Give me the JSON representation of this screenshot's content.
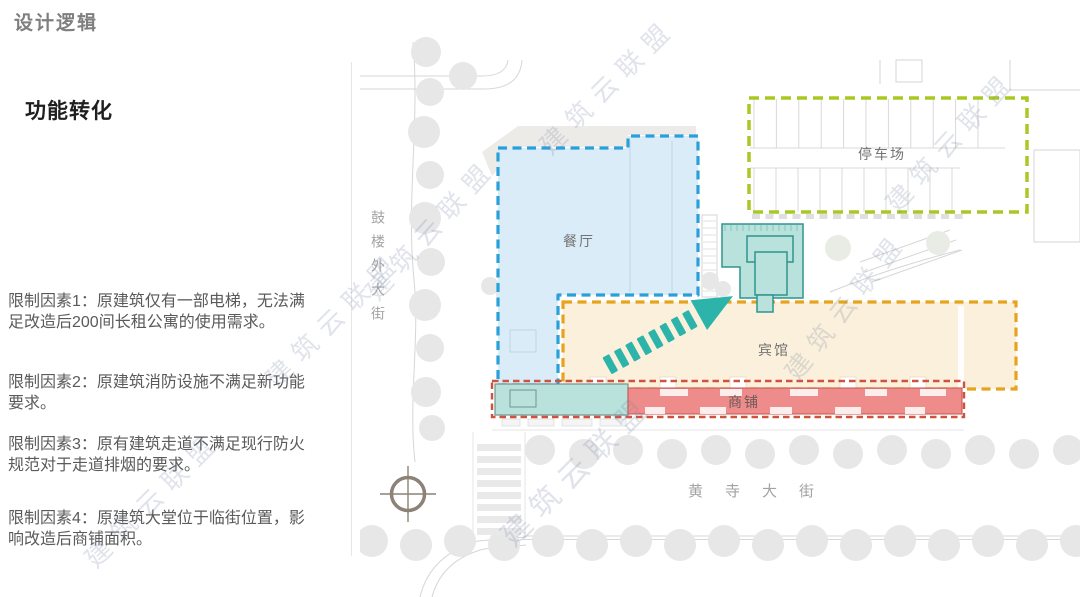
{
  "page": {
    "title": "设计逻辑",
    "section_title": "功能转化"
  },
  "constraints": [
    "限制因素1：原建筑仅有一部电梯，无法满足改造后200间长租公寓的使用需求。",
    "限制因素2：原建筑消防设施不满足新功能要求。",
    "限制因素3：原有建筑走道不满足现行防火规范对于走道排烟的要求。",
    "限制因素4：原建筑大堂位于临街位置，影响改造后商铺面积。"
  ],
  "plan": {
    "zones": {
      "restaurant": {
        "label": "餐厅",
        "outline": "#2a9fd9",
        "fill": "#daecf8"
      },
      "parking": {
        "label": "停车场",
        "outline": "#a9c822",
        "fill": "none"
      },
      "hotel": {
        "label": "宾馆",
        "outline": "#e7a31e",
        "fill": "#faf0db"
      },
      "shops": {
        "label": "商铺",
        "outline": "#cf5240",
        "fill": "#ee8b8b"
      }
    },
    "new_core": {
      "fill": "#b9e2dc",
      "outline": "#2f948c"
    },
    "arrow_color": "#2cb4ab",
    "streets": {
      "west": "鼓楼外大街",
      "south": "黄寺大街"
    }
  },
  "watermark": {
    "text": "建筑云联盟"
  }
}
